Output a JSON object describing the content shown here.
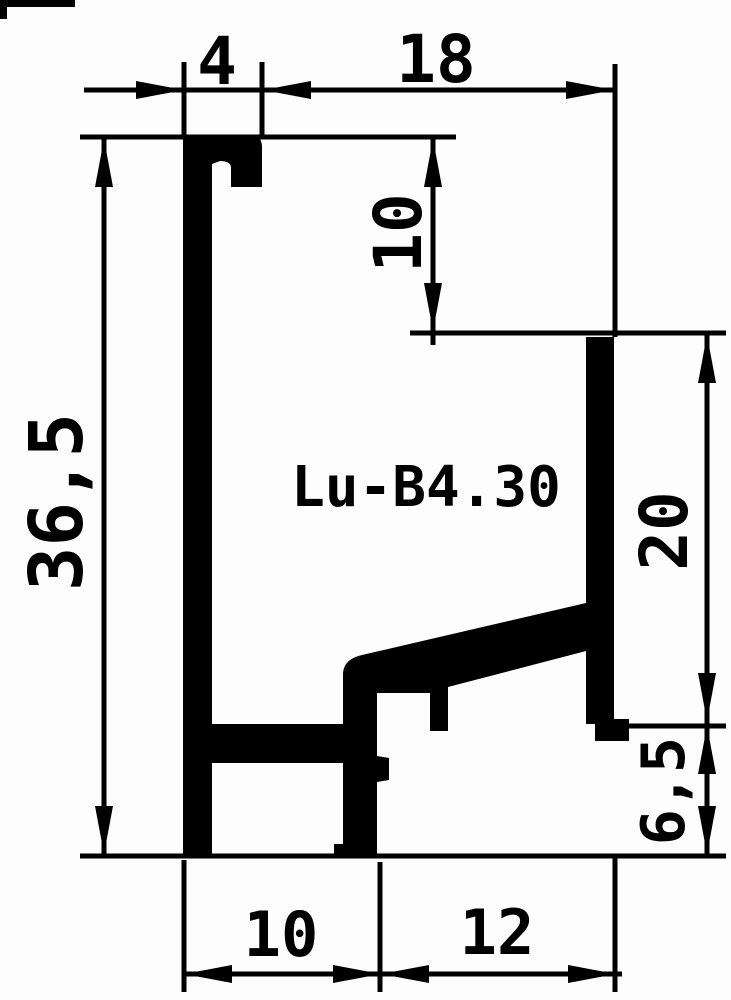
{
  "drawing": {
    "profile_name": "Lu-B4.30",
    "dimensions": {
      "top_hook_width": "4",
      "top_opening_width": "18",
      "upper_inner_height": "10",
      "overall_height": "36,5",
      "right_wall_height": "20",
      "lower_right_height": "6,5",
      "bottom_left_width": "10",
      "bottom_right_width": "12"
    },
    "colors": {
      "ink": "#000000",
      "paper": "#fdfdfd"
    }
  }
}
